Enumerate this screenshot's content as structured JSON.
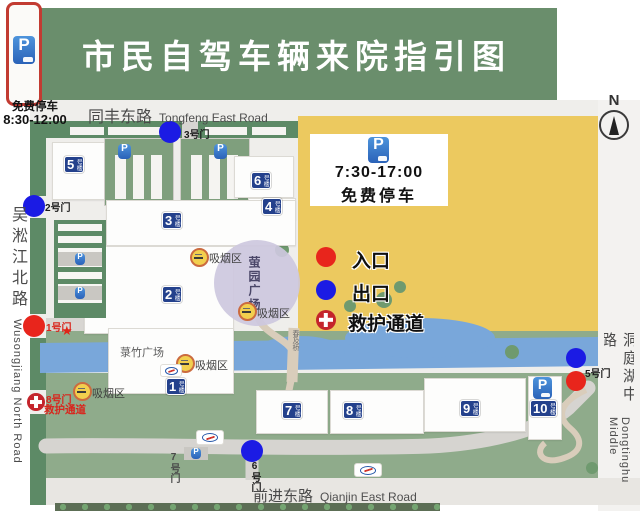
{
  "title": "市民自驾车辆来院指引图",
  "labels": {
    "p": "P",
    "north": "N"
  },
  "top_left_parking": {
    "name": "免费停车",
    "time": "8:30-12:00"
  },
  "parking_card": {
    "time": "7:30-17:00",
    "name": "免费停车"
  },
  "legend": {
    "entrance": "入口",
    "exit": "出口",
    "ambulance": "救护通道",
    "colors": {
      "entrance": "#e8251c",
      "exit": "#1b1be4",
      "ambulance": "#c4242b"
    }
  },
  "roads": {
    "top": {
      "cn": "同丰东路",
      "en": "Tongfeng East Road"
    },
    "bottom": {
      "cn": "前进东路",
      "en": "Qianjin East Road"
    },
    "left": {
      "cn": "吴淞江北路",
      "en": "Wusongjiang North Road"
    },
    "right": {
      "cn": "洞庭湖中路",
      "en": "Dongtinghu Middle"
    }
  },
  "buildings": {
    "b1": {
      "num": "1",
      "suffix": "号楼"
    },
    "b2": {
      "num": "2",
      "suffix": "号楼"
    },
    "b3": {
      "num": "3",
      "suffix": "号楼"
    },
    "b4": {
      "num": "4",
      "suffix": "号楼"
    },
    "b5": {
      "num": "5",
      "suffix": "号楼"
    },
    "b6": {
      "num": "6",
      "suffix": "号楼"
    },
    "b7": {
      "num": "7",
      "suffix": "号楼"
    },
    "b8": {
      "num": "8",
      "suffix": "号楼"
    },
    "b9": {
      "num": "9",
      "suffix": "号楼"
    },
    "b10": {
      "num": "10",
      "suffix": "号楼"
    }
  },
  "gates": {
    "g1": {
      "label": "1号门",
      "type": "entrance"
    },
    "g2": {
      "label": "2号门",
      "type": "exit"
    },
    "g3": {
      "label": "3号门",
      "type": "exit"
    },
    "g5": {
      "label": "5号门",
      "type": "entrance-exit"
    },
    "g6": {
      "label": "6号门",
      "type": "exit"
    },
    "g7": {
      "label": "7号门",
      "type": "none"
    },
    "g8": {
      "label": "8号门",
      "sub": "救护通道",
      "type": "ambulance"
    }
  },
  "places": {
    "bamboo_plaza": "菉竹广场",
    "ying_plaza": "萤园广场",
    "bridge": "春及桥",
    "smoking_area": "吸烟区"
  },
  "map_colors": {
    "banner_green": "#6a8e6c",
    "lot_yellow": "#ecc95f",
    "river_blue": "#79a7da",
    "lawn_green": "#8fab8b",
    "boundary_green": "#5d8a66"
  }
}
